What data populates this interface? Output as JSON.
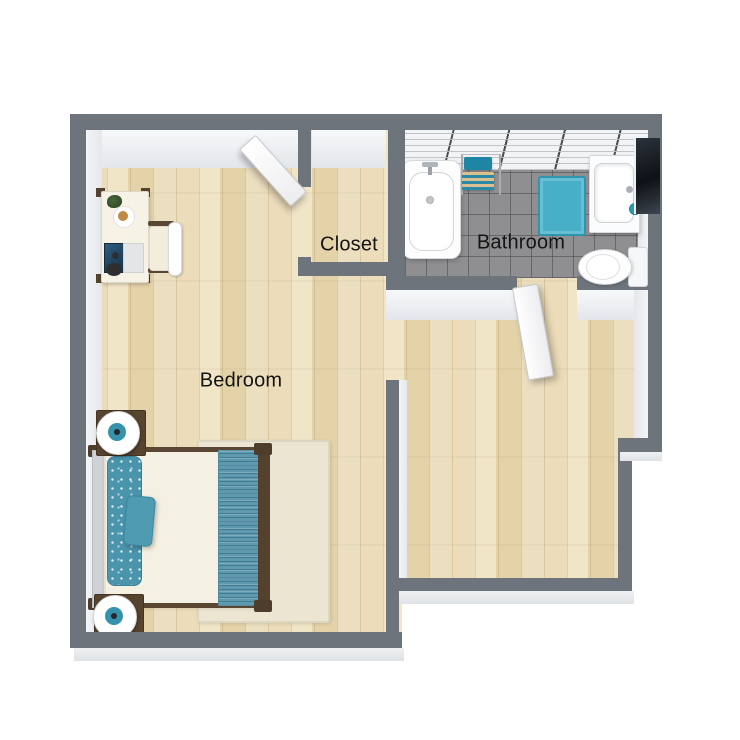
{
  "plan": {
    "rooms": [
      {
        "id": "bedroom",
        "label": "Bedroom"
      },
      {
        "id": "closet",
        "label": "Closet"
      },
      {
        "id": "bathroom",
        "label": "Bathroom"
      }
    ],
    "labels": {
      "bedroom": "Bedroom",
      "closet": "Closet",
      "bathroom": "Bathroom"
    },
    "colors": {
      "wall_gray": "#6e747c",
      "wood_floor": "#e9d8b4",
      "bathroom_tile": "#8f8f91",
      "accent_teal": "#44a8c0",
      "runner_blue": "#5f99af",
      "furniture_wood": "#57442f",
      "fixture_white": "#ffffff",
      "rug_cream": "#ece5d2"
    },
    "furniture": {
      "bedroom": [
        "desk",
        "desk-chair",
        "laptop",
        "double-bed",
        "accent-pillow",
        "bed-runner",
        "nightstand-with-lamp",
        "nightstand-with-lamp",
        "area-rug"
      ],
      "bathroom": [
        "bathtub",
        "towel-rack",
        "bath-mat",
        "vanity-sink",
        "wall-mirror",
        "toilet"
      ],
      "doors": [
        "closet-door",
        "bathroom-door"
      ]
    }
  }
}
